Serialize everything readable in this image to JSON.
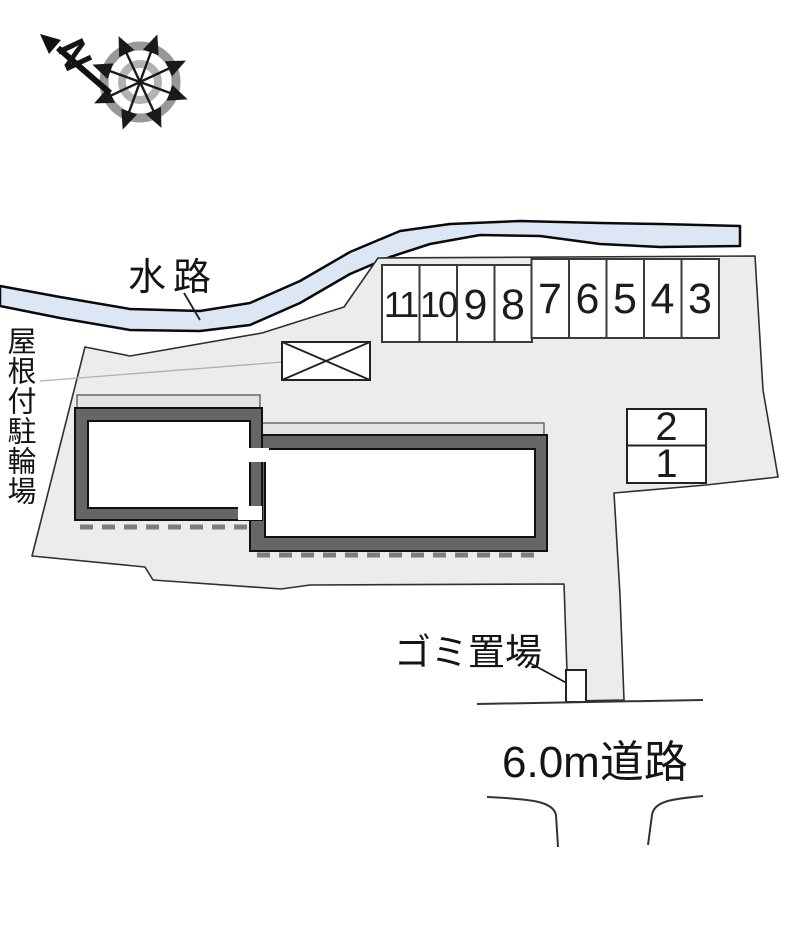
{
  "compass": {
    "north_label": "N"
  },
  "waterway": {
    "label": "水路"
  },
  "bicycle_parking": {
    "label": "屋根付駐輪場"
  },
  "parking": {
    "row_stalls": [
      "11",
      "10",
      "9",
      "8",
      "7",
      "6",
      "5",
      "4",
      "3"
    ],
    "pair_stalls": [
      "2",
      "1"
    ]
  },
  "garbage": {
    "label": "ゴミ置場"
  },
  "road": {
    "label": "6.0m道路"
  },
  "colors": {
    "site_fill": "#ececec",
    "water_fill": "#dce6f5",
    "wall_fill": "#666666",
    "eave_fill": "#e3e3e3",
    "dash_color": "#7d7d7d"
  }
}
